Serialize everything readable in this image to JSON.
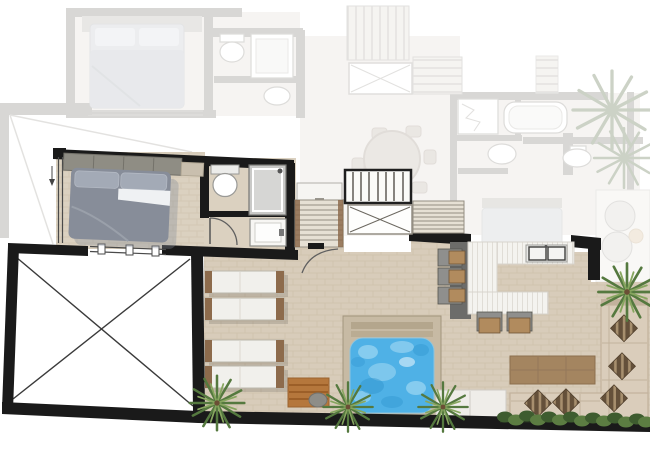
{
  "meta": {
    "label": "apartment-floor-plan",
    "type": "floor-plan-rendering",
    "levels": 2
  },
  "colors": {
    "wall": "#1a1a1a",
    "paving": "#d8ccba",
    "room_floor": "#dbd1c0",
    "fade_fill": "#eeebe6",
    "fade_wall": "#b2b0ad",
    "fade_line": "#c6c4c0",
    "bed_duvet": "#878d99",
    "bed_pillow": "#a3aab6",
    "bed_sheet": "#eff1f3",
    "closet": "#8f8d84",
    "pool_water": "#4fb1e6",
    "pool_water_light": "#b5e2f6",
    "pool_water_dark": "#2e93cd",
    "pool_deck": "#c7baa4",
    "pool_step": "#b0a28a",
    "palm_dark": "#55793f",
    "palm_light": "#87a65f",
    "palm_faded": "#9aa78f",
    "sofa": "#dacdbb",
    "sofa_edge": "#c2b29d",
    "cushion_dark": "#64503a",
    "cushion_light": "#a78f6e",
    "table_wood": "#a48560",
    "counter_dark": "#6c6c6a",
    "counter_white": "#f4f3ef",
    "counter_line": "#e0ddd6",
    "steel": "#e8e8e6",
    "stool_seat": "#b18b5e",
    "stool_frame": "#8f8f8d",
    "lounger": "#f1f0ec",
    "lounger_frame": "#8d6b4c",
    "hedge_dark": "#3e5c2f",
    "hedge_light": "#5c7d42",
    "stair": "#e6e0d4",
    "stair_line": "#948e82",
    "mat": "#b5773c",
    "stone": "#8e8d88",
    "door_line": "#5f5f5f",
    "white": "#ffffff"
  },
  "active_level": {
    "name": "main-level",
    "rooms": [
      {
        "name": "master-bedroom",
        "furniture": [
          "wardrobe",
          "double-bed"
        ]
      },
      {
        "name": "ensuite-bathroom",
        "furniture": [
          "toilet",
          "shower",
          "washbasin-cabinet"
        ]
      },
      {
        "name": "stair-hall",
        "furniture": [
          "landing-cabinet",
          "staircase-lower-flight",
          "pergola-deck",
          "skylight-void",
          "staircase-upper-flight"
        ]
      },
      {
        "name": "crossed-void-room",
        "furniture": []
      },
      {
        "name": "kitchen",
        "furniture": [
          "dark-counter",
          "u-shaped-counter",
          "double-sink",
          "bar-stools"
        ]
      },
      {
        "name": "pool-terrace",
        "furniture": [
          "sun-loungers",
          "plunge-pool",
          "towel-mat",
          "stone",
          "pool-bench"
        ]
      },
      {
        "name": "lounge-terrace",
        "furniture": [
          "wooden-table",
          "l-shaped-sofa",
          "cushions",
          "hedge",
          "palm-trees"
        ]
      }
    ],
    "counts": {
      "sun_loungers": 4,
      "bar_stools": 5,
      "palm_trees": 4,
      "sofa_cushions": 5,
      "windows": 2,
      "door_arcs": 2
    }
  },
  "faded_level": {
    "name": "upper-level-faded",
    "rooms": [
      {
        "name": "bedroom",
        "furniture": [
          "double-bed"
        ]
      },
      {
        "name": "bathroom",
        "furniture": [
          "toilet",
          "shower",
          "washbasin"
        ]
      },
      {
        "name": "dining-room",
        "furniture": [
          "round-dining-table",
          "chairs"
        ]
      },
      {
        "name": "bathroom-2",
        "furniture": [
          "glass-shower",
          "bathtub",
          "washbasin",
          "toilet"
        ]
      },
      {
        "name": "roof-decks",
        "furniture": [
          "slatted-deck-a",
          "skylight-box",
          "slatted-deck-b",
          "slatted-deck-c"
        ]
      },
      {
        "name": "balcony",
        "furniture": [
          "round-loungers",
          "side-table"
        ]
      },
      {
        "name": "roof-outline",
        "furniture": [
          "ridge-lines"
        ]
      }
    ],
    "counts": {
      "palm_trees": 2,
      "round_loungers": 2
    }
  }
}
